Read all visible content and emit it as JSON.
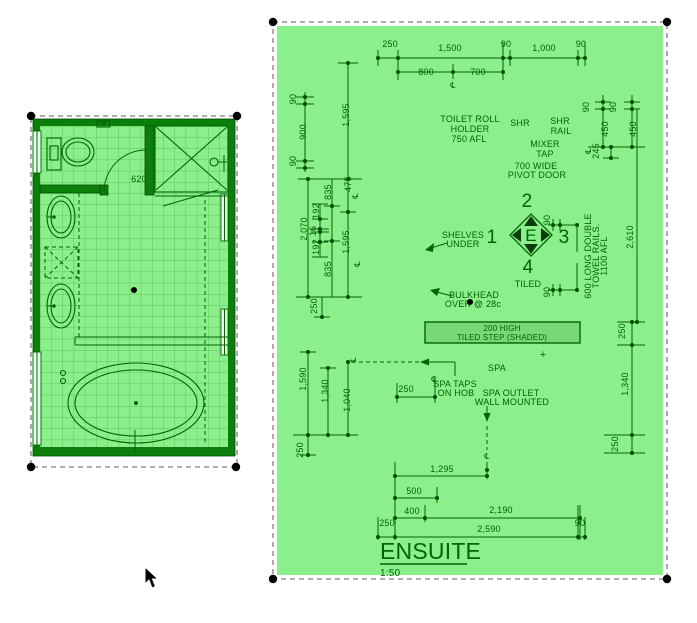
{
  "ensuite_drawing": {
    "title": "ENSUITE",
    "scale": "1:50",
    "notes": {
      "toilet_roll": [
        "TOILET ROLL",
        "HOLDER",
        "750 AFL"
      ],
      "shr": "SHR",
      "shr_rail": [
        "SHR",
        "RAIL"
      ],
      "mixer_tap": [
        "MIXER",
        "TAP"
      ],
      "pivot_door": [
        "700 WIDE",
        "PIVOT DOOR"
      ],
      "shelves": [
        "SHELVES",
        "UNDER"
      ],
      "bulkhead": [
        "BULKHEAD",
        "OVER @ 28c"
      ],
      "step": [
        "200 HIGH",
        "TILED STEP (SHADED)"
      ],
      "spa": "SPA",
      "spa_taps": [
        "SPA TAPS",
        "ON HOB"
      ],
      "spa_outlet": [
        "SPA OUTLET",
        "WALL MOUNTED"
      ],
      "towel_rails": [
        "600 LONG DOUBLE",
        "TOWEL RAILS.",
        "1100 AFL"
      ],
      "tiled": "TILED"
    },
    "elevation_marker": {
      "letter": "E",
      "left": "1",
      "top": "2",
      "right": "3",
      "bottom": "4"
    },
    "symbols": {
      "centerline": "℄",
      "plus": "+"
    },
    "dims": {
      "top": [
        "250",
        "1,500",
        "90",
        "1,000",
        "90"
      ],
      "top2": [
        "800",
        "700"
      ],
      "left_upper": [
        "90",
        "900",
        "90",
        "1,595"
      ],
      "left_mid": [
        "475",
        "835",
        "192",
        "2,070",
        "16",
        "192",
        "1,595",
        "835",
        "250"
      ],
      "left_lower": [
        "1,590",
        "1,340",
        "1,040",
        "250"
      ],
      "right_upper": [
        "90",
        "90",
        "450",
        "450",
        "245",
        "2,610"
      ],
      "right_mid": [
        "90",
        "90",
        "250"
      ],
      "right_lower": [
        "1,340",
        "250"
      ],
      "spa_taps_offset": "250",
      "bottom": [
        "1,295",
        "500",
        "400",
        "2,190",
        "250",
        "90",
        "2,590"
      ]
    },
    "colors": {
      "canvas_fill": "#8bef8b",
      "line": "#006400",
      "wall": "#0b7e0b",
      "step_fill": "#76d976"
    }
  },
  "floor_plan": {
    "door_dim": "620"
  }
}
